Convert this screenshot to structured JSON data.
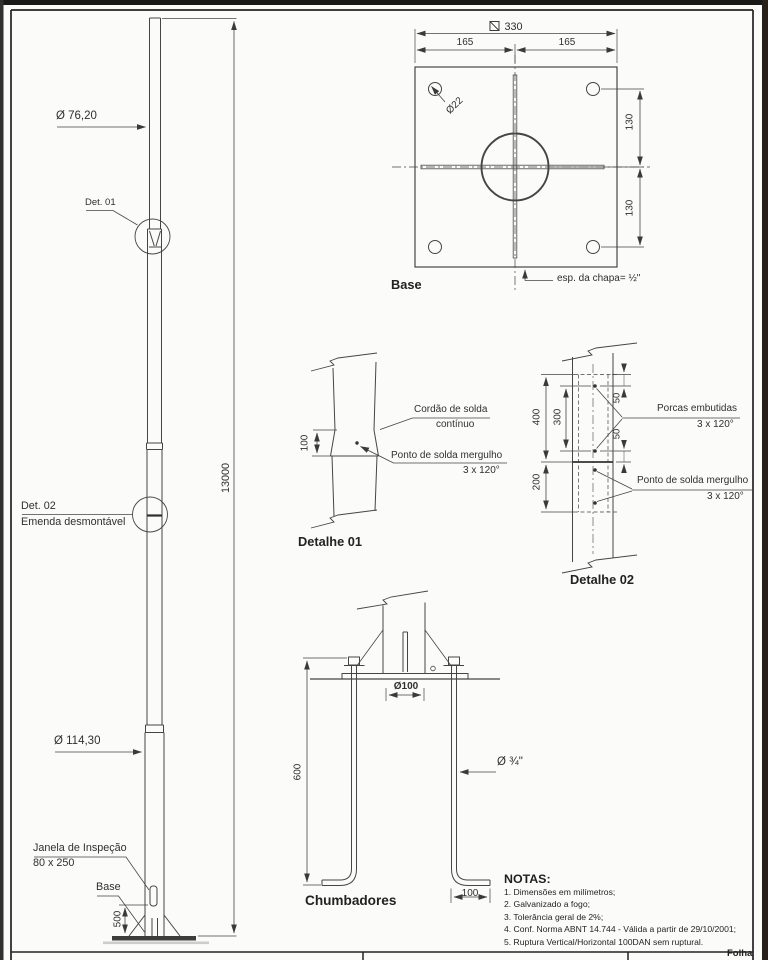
{
  "sheet": {
    "pole_view": {
      "dia_top": "Ø 76,20",
      "det01_label": "Det. 01",
      "det02_label": "Det. 02",
      "det02_sub": "Emenda desmontável",
      "total_height": "13000",
      "dia_bottom": "Ø 114,30",
      "window_label": "Janela de Inspeção",
      "window_size": "80 x 250",
      "base_label": "Base",
      "base_height": "500"
    },
    "base_view": {
      "title": "Base",
      "width_total": "330",
      "width_half_left": "165",
      "width_half_right": "165",
      "hole_dia": "Ø22",
      "height_upper": "130",
      "height_lower": "130",
      "thickness": "esp. da chapa= ½\""
    },
    "detail01": {
      "title": "Detalhe 01",
      "overlap": "100",
      "weld_seam_line1": "Cordão de solda",
      "weld_seam_line2": "contínuo",
      "weld_spot_line1": "Ponto de solda mergulho",
      "weld_spot_line2": "3 x 120°"
    },
    "detail02": {
      "title": "Detalhe 02",
      "dim_400": "400",
      "dim_300": "300",
      "dim_200": "200",
      "dim_50_top": "50",
      "dim_50_bottom": "50",
      "nuts_line1": "Porcas embutidas",
      "nuts_line2": "3 x 120°",
      "spot_line1": "Ponto de solda mergulho",
      "spot_line2": "3 x 120°"
    },
    "anchors": {
      "title": "Chumbadores",
      "center_dia": "Ø100",
      "length": "600",
      "bolt_dia": "Ø ¾\"",
      "hook_length": "100"
    },
    "notes": {
      "title": "NOTAS:",
      "items": [
        "1. Dimensões em milímetros;",
        "2. Galvanizado a fogo;",
        "3. Tolerância geral de 2%;",
        "4. Conf. Norma ABNT 14.744 - Válida a partir de 29/10/2001;",
        "5. Ruptura Vertical/Horizontal 100DAN sem ruptural."
      ]
    },
    "title_block": {
      "folha": "Folha"
    }
  }
}
